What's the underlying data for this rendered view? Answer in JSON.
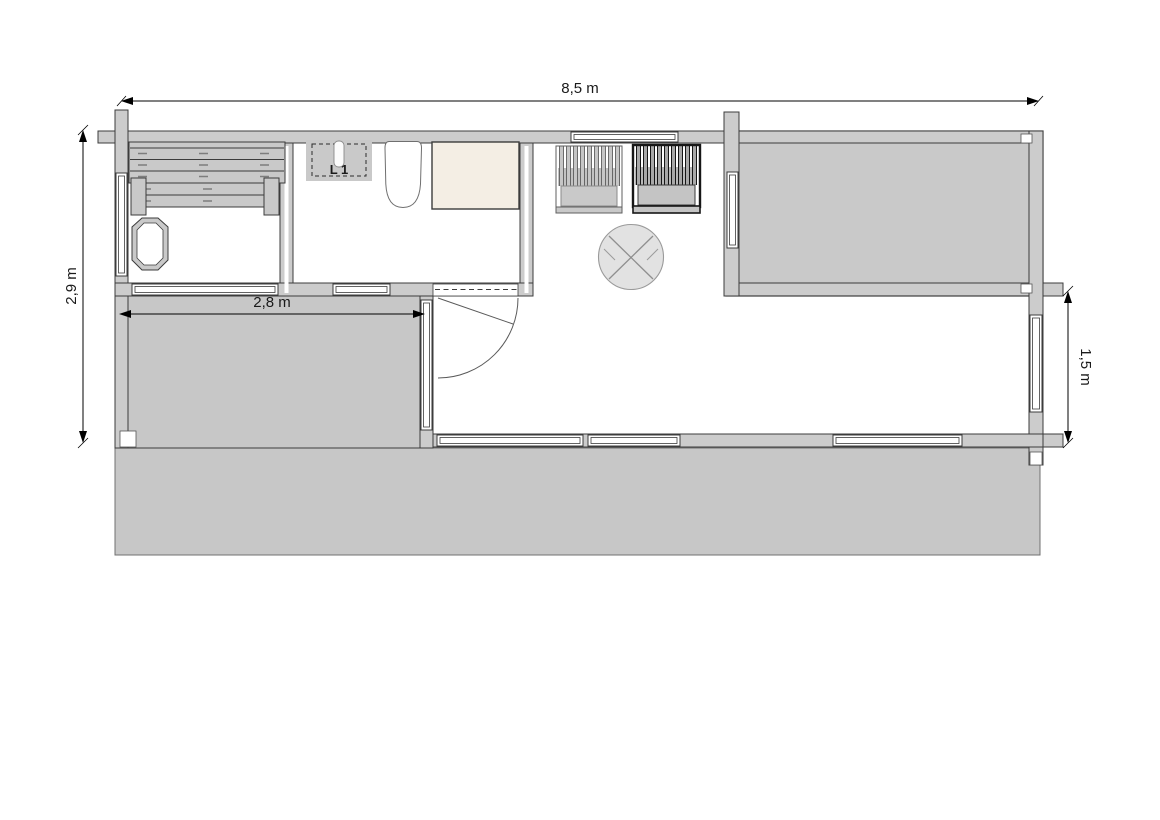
{
  "drawing": {
    "kind": "sauna-cabin-floor-plan",
    "dimensions": {
      "overall_width": "8,5 m",
      "overall_depth": "2,9 m",
      "terrace_width": "2,8 m",
      "side_terrace_depth": "1,5 m"
    },
    "labels": {
      "fixture": "L 1"
    },
    "colors": {
      "background": "#ffffff",
      "wall_fill": "#cccccc",
      "floor_fill": "#c7c7c7",
      "outline": "#3c3c3c",
      "shower_fill": "#f4eee4",
      "table_fill": "#e2e2e2",
      "dimension_text": "#1a1a1a"
    }
  }
}
